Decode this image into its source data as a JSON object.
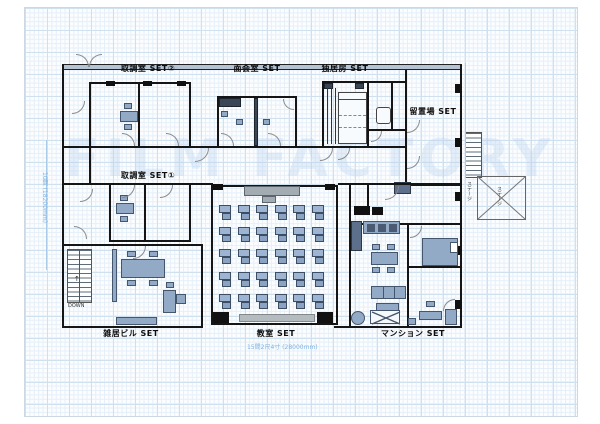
{
  "sheet": {
    "watermark": "FILM FACTORY"
  },
  "rooms": {
    "interrogation2": "取調室 SET②",
    "meeting": "面会室 SET",
    "solitary": "独居房 SET",
    "detention": "留置場 SET",
    "interrogation1": "取調室 SET①",
    "tenant_building": "雑居ビル SET",
    "classroom": "教室 SET",
    "apartment": "マンション SET"
  },
  "annotations": {
    "stairs_down": "DOWN",
    "stairs_arrow": "↑",
    "width_dimension": "15間2尺4寸 (28000mm)",
    "height_dimension": "10間 (18200mm)",
    "stage_note_left": "ステージ",
    "stage_note_right": "ステージ"
  },
  "classroom_layout": {
    "rows": 5,
    "cols": 6,
    "desk_count": 30
  },
  "colors": {
    "wall": "#151515",
    "furniture": "#93aac7",
    "grid": "#cfe0ef",
    "dimension": "#7fb2e0"
  }
}
